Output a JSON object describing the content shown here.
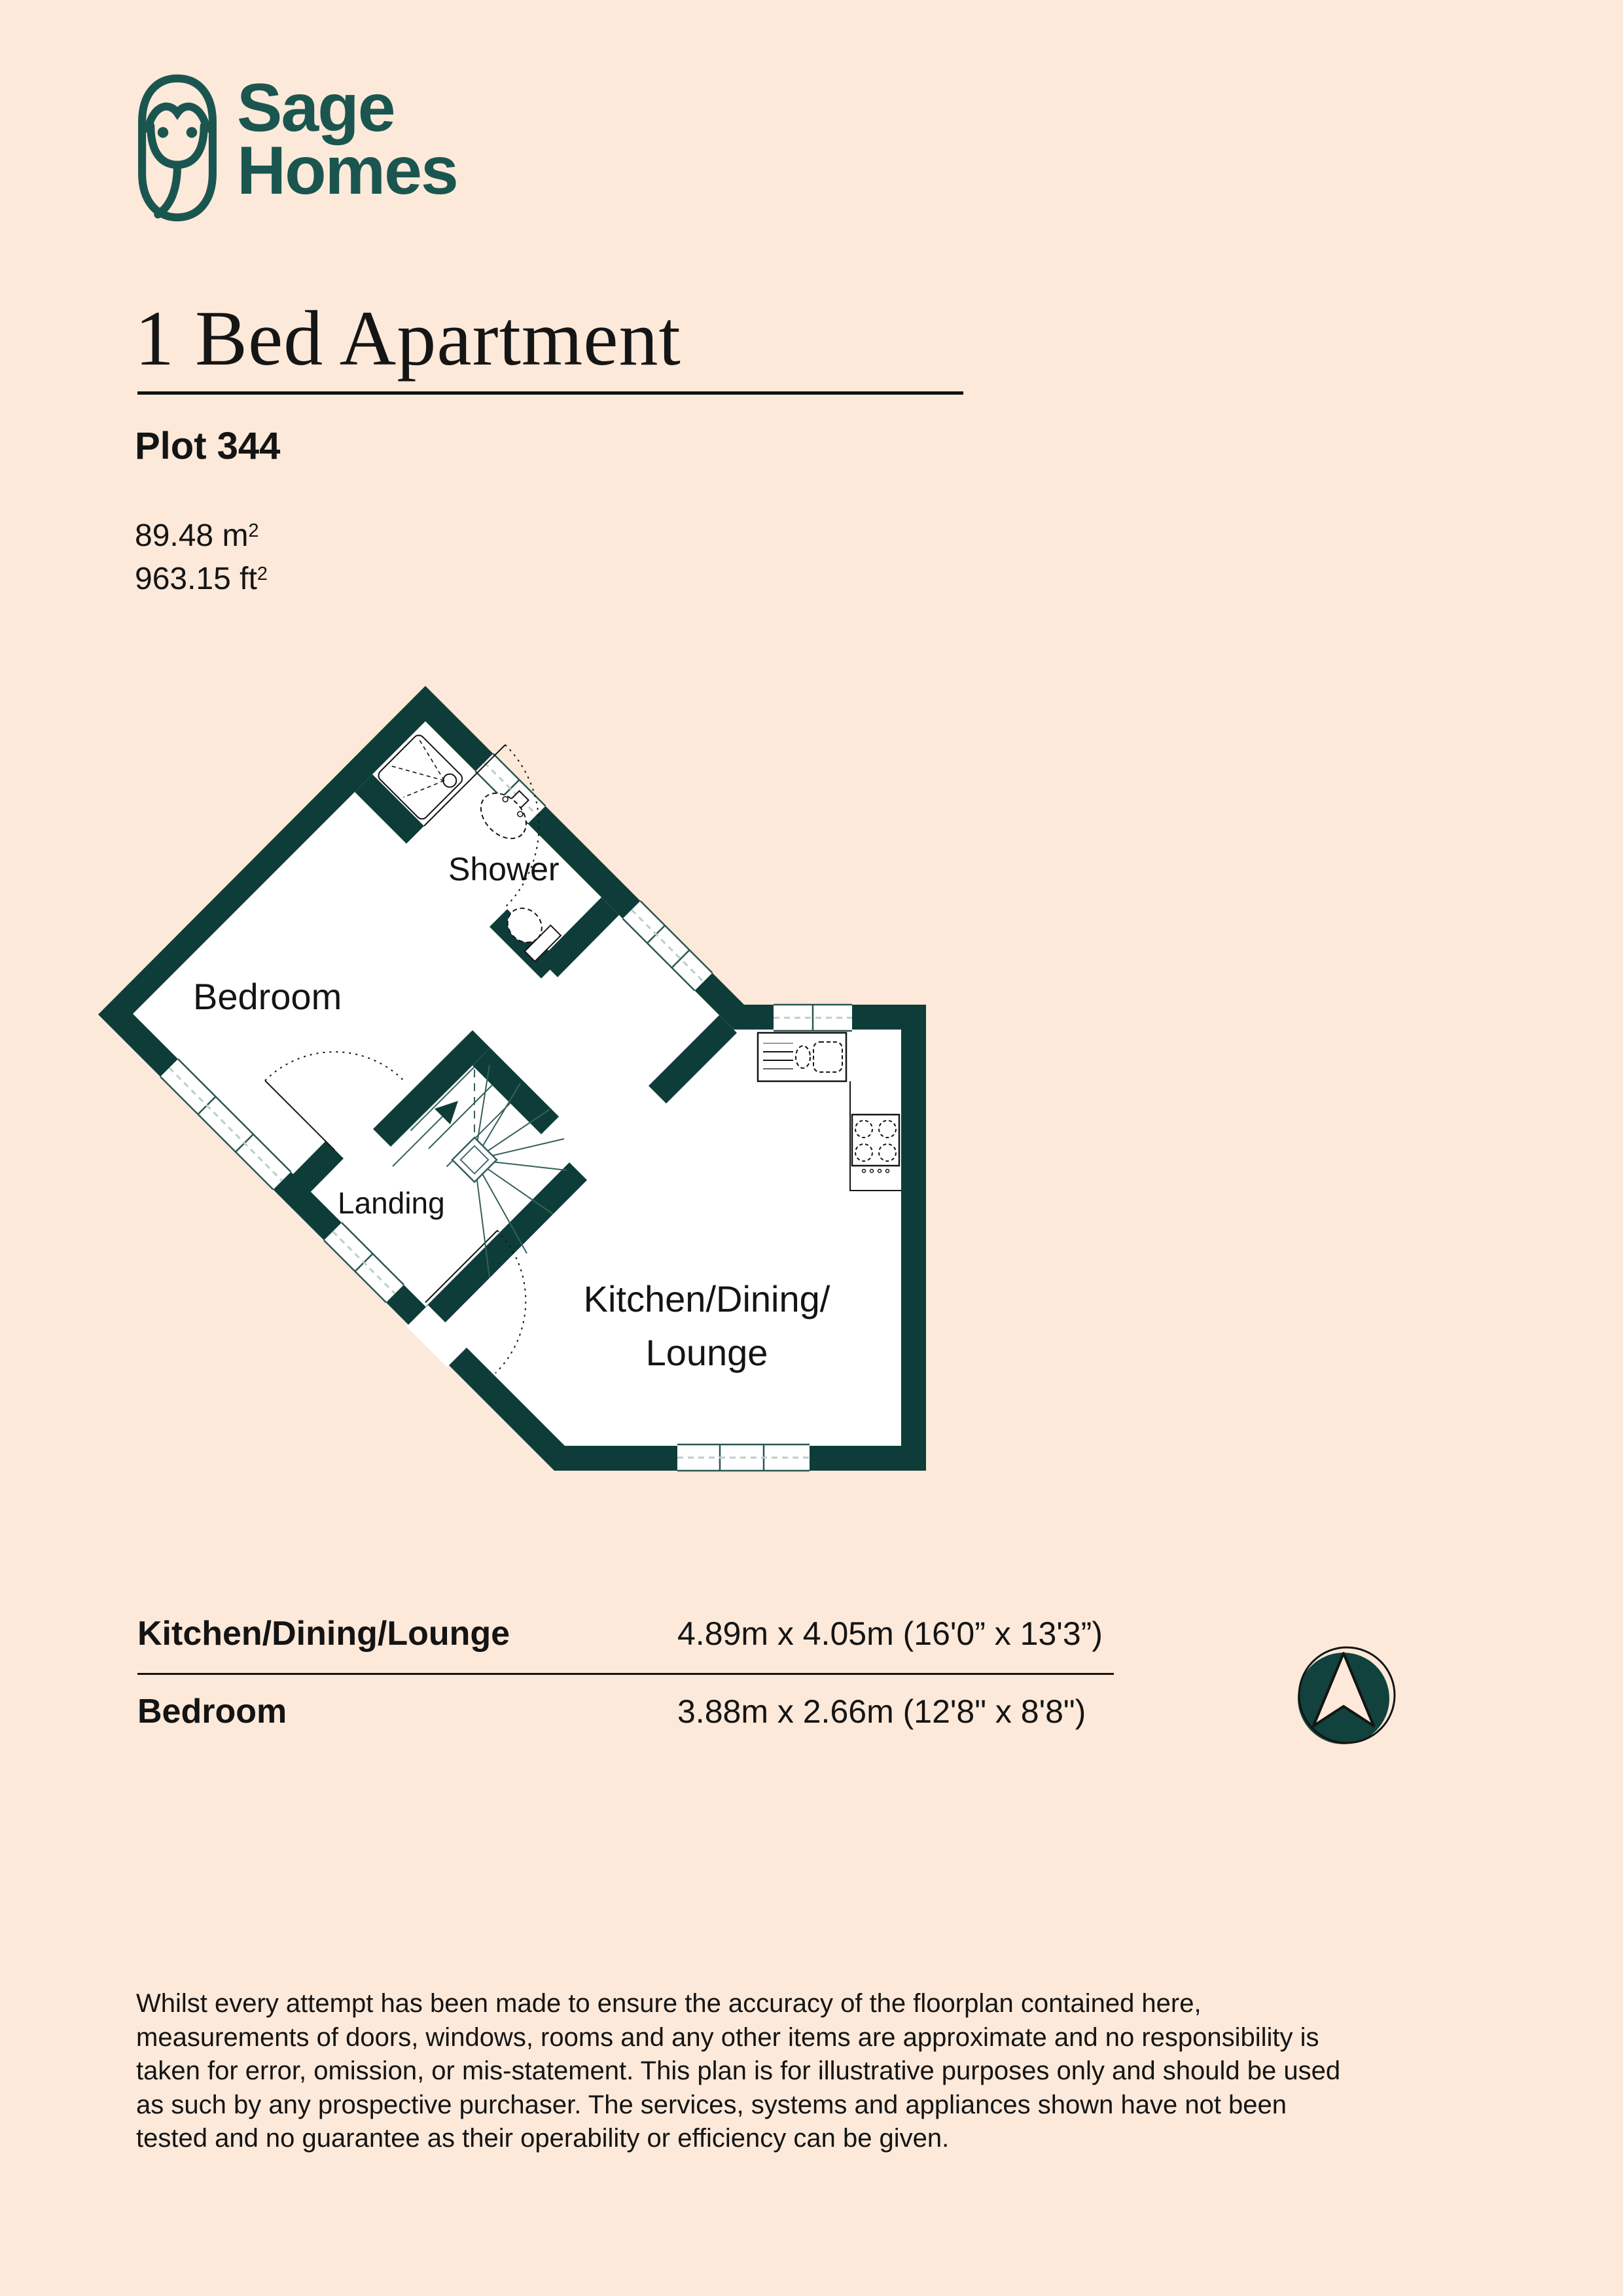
{
  "colors": {
    "background": "#fce9da",
    "wall_teal": "#0e3d39",
    "logo_teal": "#1a564f",
    "plan_line": "#2a554f",
    "window_center": "#b9cfc8",
    "text": "#141414"
  },
  "brand": {
    "line1": "Sage",
    "line2": "Homes"
  },
  "header": {
    "title": "1 Bed Apartment",
    "plot": "Plot 344",
    "area_sqm": "89.48 m",
    "area_sqm_sup": "2",
    "area_sqft": "963.15 ft",
    "area_sqft_sup": "2"
  },
  "floorplan": {
    "labels": {
      "shower": "Shower",
      "bedroom": "Bedroom",
      "landing": "Landing",
      "kitchen_line1": "Kitchen/Dining/",
      "kitchen_line2": "Lounge"
    }
  },
  "dimensions_table": {
    "rows": [
      {
        "room": "Kitchen/Dining/Lounge",
        "size": "4.89m x 4.05m (16'0” x 13'3”)"
      },
      {
        "room": "Bedroom",
        "size": "3.88m x 2.66m (12'8\" x 8'8\")"
      }
    ]
  },
  "disclaimer": "Whilst every attempt has been made to ensure the accuracy of the floorplan contained here, measurements of doors, windows, rooms and any other items are approximate and no responsibility is taken for error, omission, or mis-statement. This plan is for illustrative purposes only and should be used as such by any prospective purchaser. The services, systems and appliances shown have not been tested and no guarantee as their operability or efficiency can be given."
}
